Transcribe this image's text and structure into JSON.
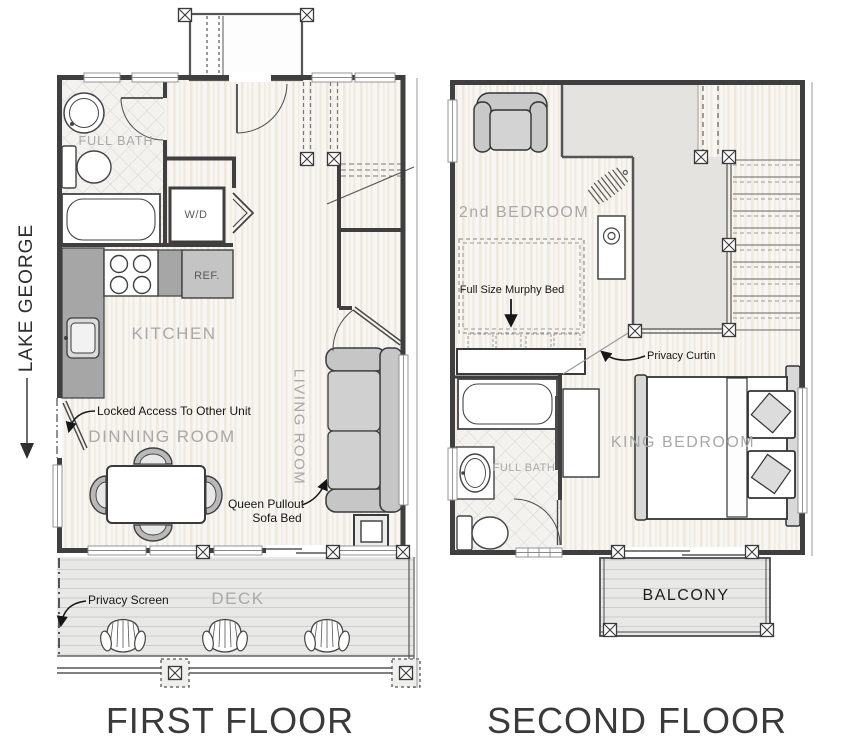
{
  "document": {
    "background": "#ffffff"
  },
  "orientation_label": {
    "text": "LAKE GEORGE"
  },
  "first_floor": {
    "title": "FIRST FLOOR",
    "room_labels": {
      "full_bath": "FULL BATH",
      "kitchen": "KITCHEN",
      "dinning_room": "DINNING ROOM",
      "living_room": "LIVING ROOM",
      "deck": "DECK"
    },
    "appliance_labels": {
      "washer_dryer": "W/D",
      "refrigerator": "REF."
    },
    "annotations": {
      "locked_access": "Locked Access To Other Unit",
      "queen_pullout_line1": "Queen Pullout",
      "queen_pullout_line2": "Sofa Bed",
      "privacy_screen": "Privacy Screen"
    }
  },
  "second_floor": {
    "title": "SECOND FLOOR",
    "room_labels": {
      "second_bedroom": "2nd BEDROOM",
      "king_bedroom": "KING BEDROOM",
      "full_bath": "FULL BATH",
      "balcony": "BALCONY"
    },
    "annotations": {
      "murphy_bed": "Full Size Murphy Bed",
      "privacy_curtain": "Privacy Curtin"
    }
  },
  "colors": {
    "wall": "#3f3f3f",
    "room_label": "#a8a8a8",
    "annotation": "#161616",
    "counter": "#a6a6a6",
    "furniture": "#c9c9c9",
    "open_to_below": "#e4e3e0",
    "title": "#3a3a3a"
  }
}
